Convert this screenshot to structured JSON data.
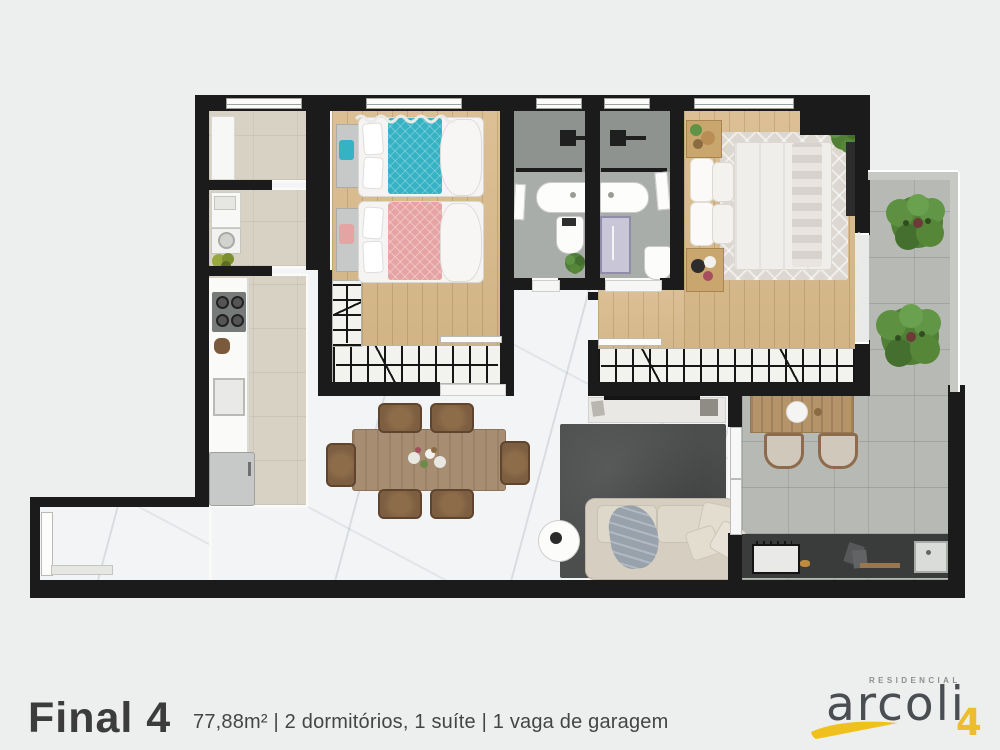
{
  "caption": {
    "title": "Final 4",
    "specs": "77,88m² | 2 dormitórios, 1 suíte | 1 vaga de garagem"
  },
  "logo": {
    "tagline": "RESIDENCIAL",
    "name": "arcoli",
    "unit": "4"
  },
  "palette": {
    "background": "#ecefee",
    "wall": "#1b1b1b",
    "wall_trim": "#fafaf8",
    "marble_floor": "#f3f4f6",
    "wood_floor": "#d7ba8d",
    "kitchen_floor": "#d8d2c4",
    "bathroom_floor": "#a9ada9",
    "terrace_concrete": "#b7bab4",
    "teal_bed": "#35b3c4",
    "pink_bed": "#e6a3a3",
    "living_rug": "#4b4e4d",
    "sofa": "#d6cfc1",
    "logo_accent": "#eebd2d",
    "logo_text": "#4a4d52",
    "tree_green": "#517f35"
  }
}
